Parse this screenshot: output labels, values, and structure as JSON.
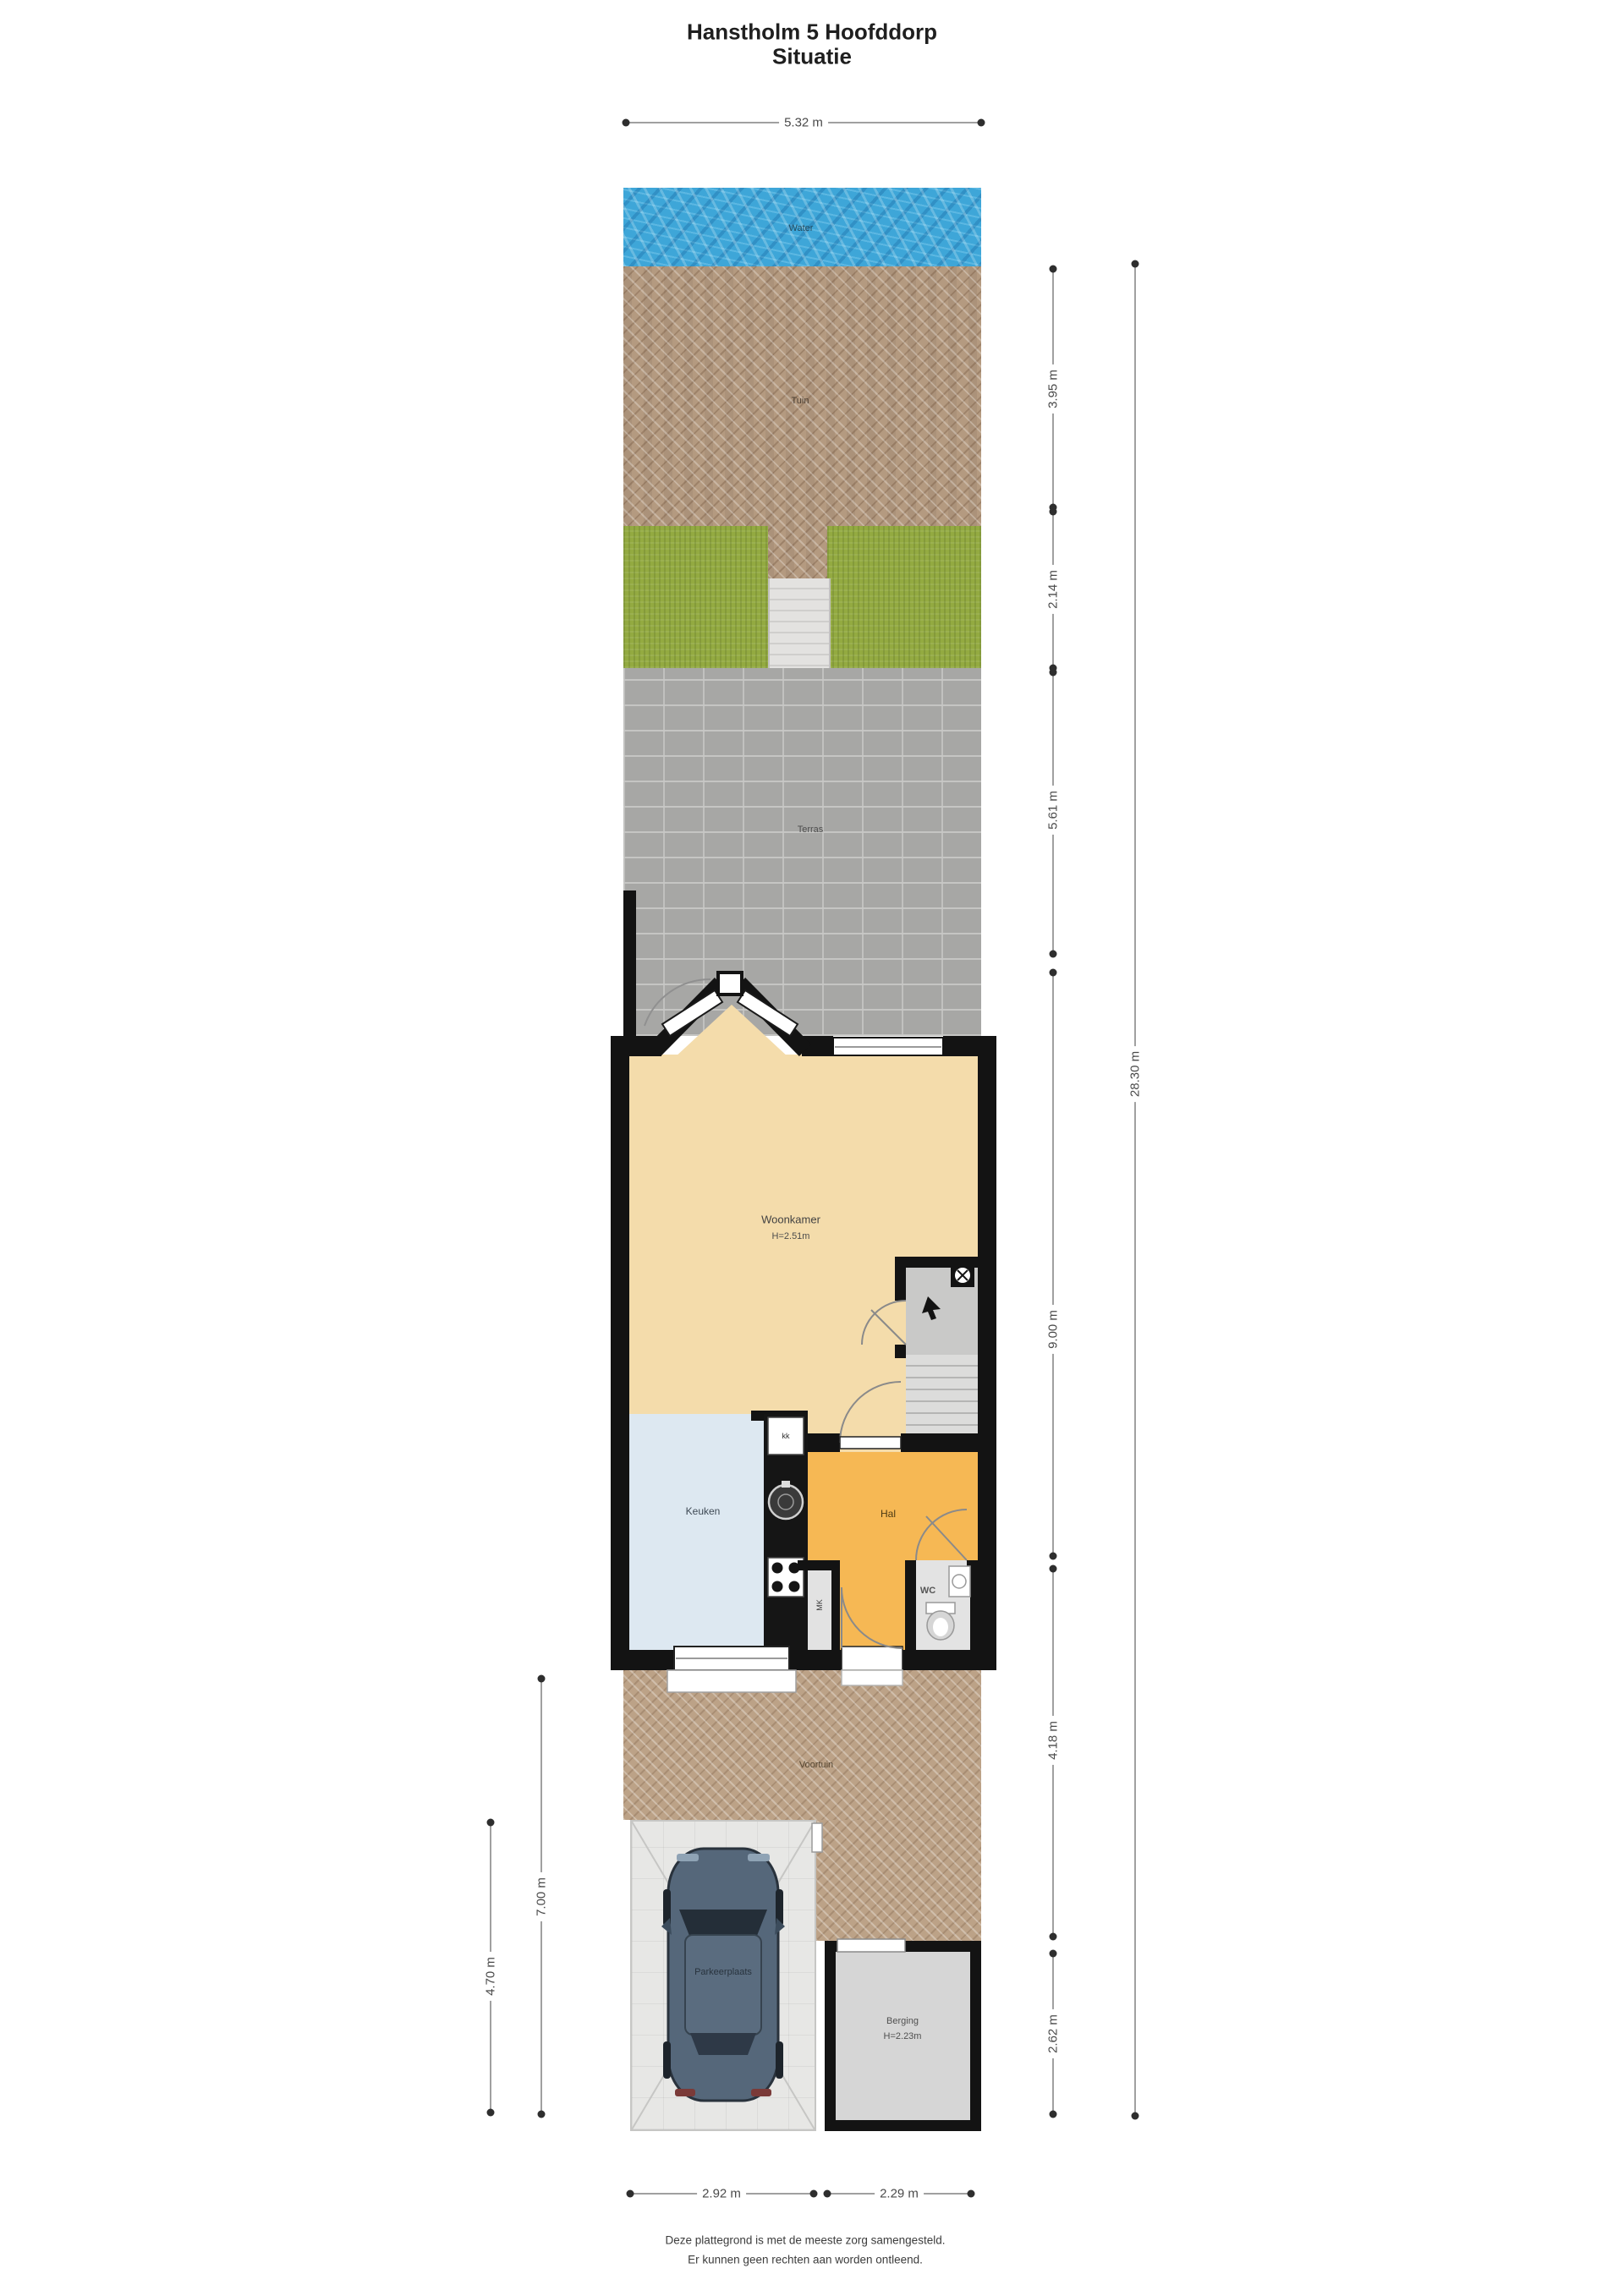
{
  "title": {
    "line1": "Hanstholm 5 Hoofddorp",
    "line2": "Situatie"
  },
  "labels": {
    "water": "Water",
    "tuin": "Tuin",
    "terras": "Terras",
    "woonkamer": "Woonkamer",
    "woonkamer_h": "H=2.51m",
    "keuken": "Keuken",
    "fridge": "kk",
    "hal": "Hal",
    "mk": "MK",
    "wc": "WC",
    "voortuin": "Voortuin",
    "parkeerplaats": "Parkeerplaats",
    "berging": "Berging",
    "berging_h": "H=2.23m"
  },
  "dimensions": {
    "top": "5.32 m",
    "right_segments": [
      "3.95 m",
      "2.14 m",
      "5.61 m",
      "9.00 m",
      "4.18 m",
      "2.62 m"
    ],
    "right_total": "28.30 m",
    "left_outer": "7.00 m",
    "left_inner": "4.70 m",
    "bottom": [
      "2.92 m",
      "2.29 m"
    ]
  },
  "footer": {
    "line1": "Deze plattegrond is met de meeste zorg samengesteld.",
    "line2": "Er kunnen geen rechten aan worden ontleend."
  },
  "colors": {
    "water": "#3ea6d8",
    "garden_paving": "#b49a80",
    "grass": "#93aa41",
    "terrace": "#a7a7a5",
    "living_floor": "#f4dcab",
    "kitchen_floor": "#dde8f1",
    "hall_floor": "#f6b854",
    "walls": "#131313",
    "car_body": "#55677a"
  }
}
